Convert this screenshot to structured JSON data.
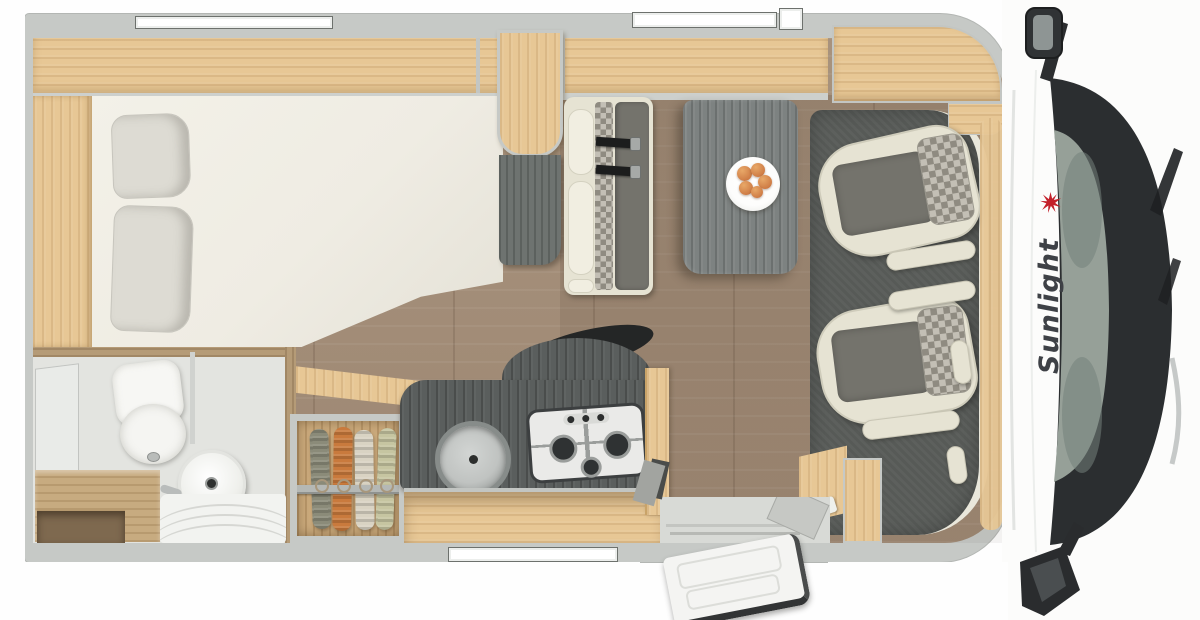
{
  "page": {
    "title": "Sunlight motorhome floor plan - top view"
  },
  "vehicle": {
    "brand_logo": "Sunlight",
    "zones": [
      "rear-french-bed",
      "bathroom",
      "wardrobe",
      "kitchen",
      "dinette",
      "swivel-cab-seats",
      "entry-door",
      "cab-front"
    ]
  },
  "icons": {
    "logo_burst": "red-sunburst-star",
    "windows": [
      "top-window",
      "top-window-2",
      "roof-vent",
      "bottom-window"
    ],
    "mirrors": [
      "top-side-mirror",
      "bottom-side-mirror"
    ]
  },
  "colors": {
    "wall": "#c6c9c6",
    "wall_lip": "#cdd0cd",
    "wood": "#e7c795",
    "bath_wood": "#b59b77",
    "wardrobe_wood": "#cbaa7c",
    "floor": "#a8937e",
    "bed": "#efece3",
    "pillow": "#dddbd3",
    "counter": "#5a5e5d",
    "table": "#7d8281",
    "mat": "#575a57",
    "seat_cream": "#e6e3d3",
    "seat_dark": "#74736c",
    "checker_light": "#c3bfb5",
    "checker_dark": "#8f8b81",
    "windshield": "#2b2e30",
    "glass": "#96a098",
    "logo_red": "#c3202a",
    "logo_gray": "#3e4146",
    "belt": "#1c1d1d",
    "plate": "#fdfdfc",
    "fruit": "#cf7d46",
    "fruit_light": "#e8a868",
    "door_white": "#f4f4f2",
    "clothes": [
      "#8b8b79",
      "#c97a3d",
      "#d9d3c3",
      "#c6c5a1"
    ]
  }
}
